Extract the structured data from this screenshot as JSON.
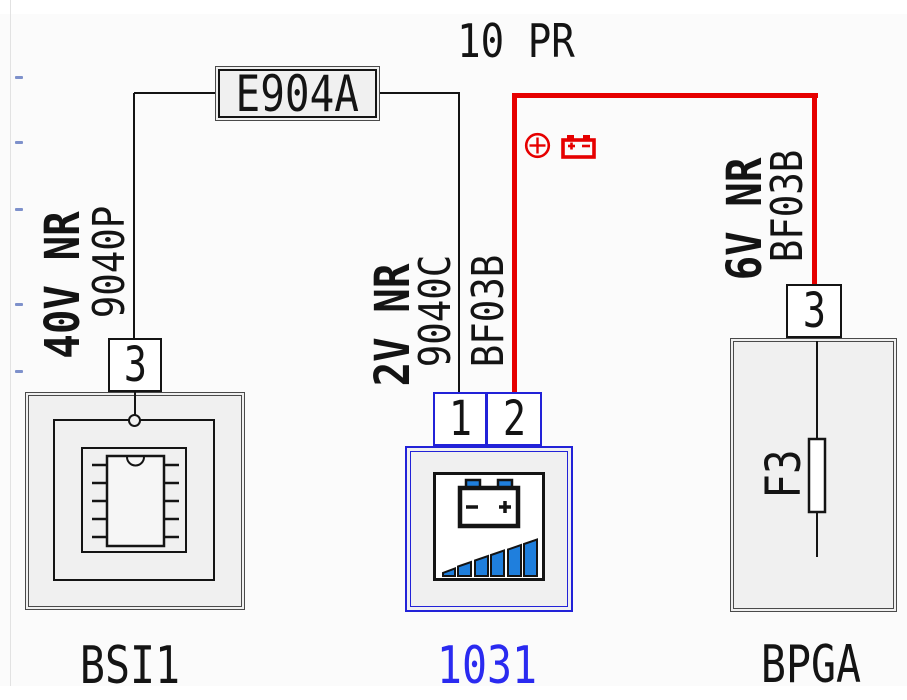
{
  "diagram": {
    "title": "10 PR",
    "splice_label": "E904A",
    "wires": [
      {
        "label": "40V NR",
        "code": "9040P"
      },
      {
        "label": "2V NR",
        "code": "9040C",
        "harness": "BF03B"
      },
      {
        "label": "6V NR",
        "harness": "BF03B"
      }
    ],
    "components": [
      {
        "id": "BSI1",
        "label": "BSI1",
        "pins": [
          "3"
        ],
        "icon": "microcontroller-icon"
      },
      {
        "id": "1031",
        "label": "1031",
        "pins": [
          "1",
          "2"
        ],
        "icon": "battery-charge-icon"
      },
      {
        "id": "BPGA",
        "label": "BPGA",
        "pins": [
          "3"
        ],
        "fuse": "F3",
        "icon": "fuse-icon"
      }
    ],
    "symbols": {
      "supply_positive": "plus-circle-icon",
      "supply_battery": "battery-icon"
    },
    "colors": {
      "wire-red": "#e60000",
      "component-blue": "#2222d8",
      "label-blue": "#2a2af0",
      "bar-blue": "#1f7fdd",
      "box-fill": "#f0f0f0",
      "ink": "#141414"
    }
  }
}
